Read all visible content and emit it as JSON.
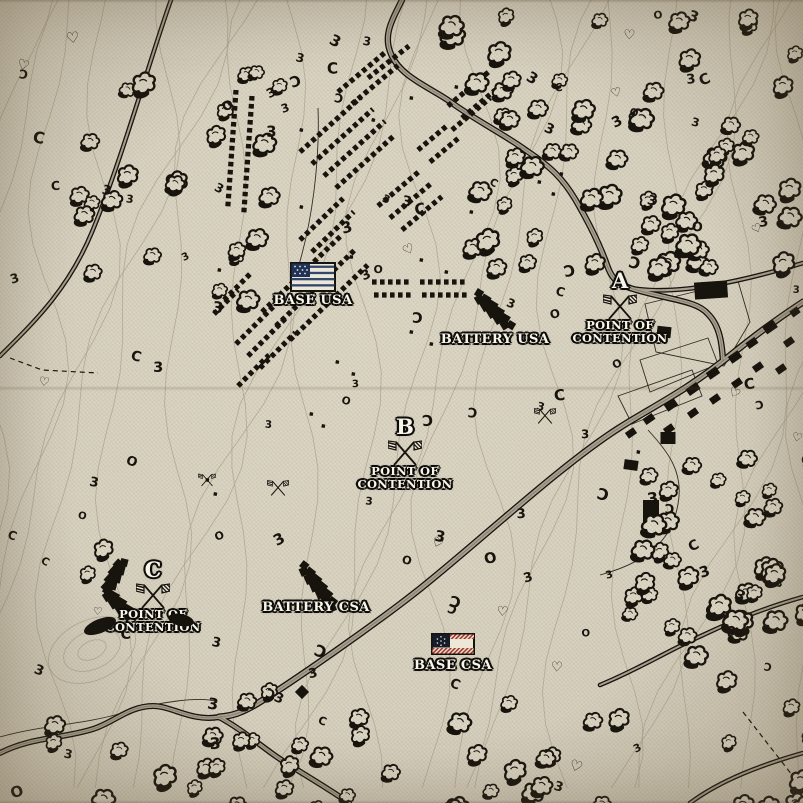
{
  "colors": {
    "parchment": "#d8d2c1",
    "ink": "#16130d",
    "contour": "#b3aa95",
    "road_fill": "#aba393",
    "road_center": "#6e695c",
    "label_text": "#f8f5ea",
    "usa_canton": "#1f3156",
    "usa_stripe": "#31476e",
    "csa_canton": "#171c2a",
    "csa_red": "#9e2a1f",
    "flag_white": "#ece7d7"
  },
  "markers": {
    "base_usa": {
      "label": "BASE USA",
      "x": 313,
      "y": 262
    },
    "battery_usa": {
      "label": "BATTERY USA",
      "x": 495,
      "y": 331
    },
    "battery_csa": {
      "label": "BATTERY CSA",
      "x": 316,
      "y": 599
    },
    "base_csa": {
      "label": "BASE CSA",
      "x": 453,
      "y": 633
    },
    "points_of_contention": [
      {
        "letter": "A",
        "line1": "POINT OF",
        "line2": "CONTENTION",
        "x": 620,
        "y": 270
      },
      {
        "letter": "B",
        "line1": "POINT OF",
        "line2": "CONTENTION",
        "x": 405,
        "y": 416
      },
      {
        "letter": "C",
        "line1": "POINT OF",
        "line2": "CONTENTION",
        "x": 153,
        "y": 559
      }
    ]
  },
  "features": {
    "roads": [
      {
        "d": "M171,0 C152,52 122,160 92,232 C68,290 34,322 0,356",
        "w": 4.6
      },
      {
        "d": "M402,0 C391,22 383,36 391,54 C401,78 432,88 452,103 C477,121 505,135 527,151 C551,167 563,179 575,199 C589,223 600,245 607,265 C611,277 616,283 630,288",
        "w": 6.4
      },
      {
        "d": "M630,288 C668,300 696,300 708,314 C720,326 722,344 723,361",
        "w": 6.4
      },
      {
        "d": "M630,288 C676,296 740,282 803,263",
        "w": 4.8
      },
      {
        "d": "M803,302 C762,329 741,347 723,361 C682,393 652,407 619,428 C561,465 481,540 421,588 C381,620 301,676 263,700 C241,714 231,716 219,717",
        "w": 7
      },
      {
        "d": "M219,717 C192,722 172,706 153,706 C129,706 113,723 93,729 C61,739 31,737 0,753",
        "w": 6
      },
      {
        "d": "M219,717 C241,729 257,743 277,757 C301,773 323,785 349,803",
        "w": 6
      },
      {
        "d": "M600,685 C641,668 669,650 701,636 C741,617 771,606 803,597",
        "w": 4.6
      },
      {
        "d": "M690,803 C721,780 761,765 803,753",
        "w": 4.6
      }
    ],
    "boundaries": [
      "M645,304 L738,281 L750,322 L724,366 L656,352 Z",
      "M640,360 L708,338 L718,364 L650,392 Z",
      "M618,396 L692,370 L702,396 L632,424 Z",
      "M318,108 C320,162 312,222 298,268",
      "M648,430 C668,452 684,472 678,504 C672,540 648,562 600,575",
      "M0,737 C42,725 82,725 122,713 C162,701 198,697 215,701"
    ],
    "fences": [
      "M743,712 L803,789",
      "M10,358 L42,370 L98,373"
    ],
    "tent_rows": [
      [
        236,
        90,
        94,
        118
      ],
      [
        252,
        96,
        94,
        120
      ],
      [
        300,
        152,
        -42,
        82
      ],
      [
        312,
        164,
        -42,
        82
      ],
      [
        324,
        176,
        -42,
        82
      ],
      [
        336,
        188,
        -42,
        80
      ],
      [
        262,
        312,
        -44,
        112
      ],
      [
        276,
        326,
        -44,
        112
      ],
      [
        290,
        340,
        -44,
        108
      ],
      [
        300,
        240,
        -44,
        60
      ],
      [
        312,
        252,
        -44,
        58
      ],
      [
        338,
        92,
        -40,
        62
      ],
      [
        352,
        104,
        -40,
        60
      ],
      [
        368,
        78,
        -38,
        52
      ],
      [
        448,
        106,
        -40,
        56
      ],
      [
        462,
        118,
        -40,
        54
      ],
      [
        452,
        130,
        -40,
        50
      ],
      [
        378,
        206,
        -40,
        56
      ],
      [
        390,
        218,
        -40,
        56
      ],
      [
        402,
        230,
        -40,
        52
      ],
      [
        418,
        150,
        -40,
        40
      ],
      [
        430,
        162,
        -40,
        40
      ],
      [
        372,
        282,
        0,
        40
      ],
      [
        420,
        282,
        0,
        46
      ],
      [
        374,
        295,
        0,
        40
      ],
      [
        422,
        295,
        0,
        46
      ],
      [
        236,
        344,
        -45,
        56
      ],
      [
        248,
        356,
        -45,
        54
      ],
      [
        260,
        368,
        -45,
        50
      ],
      [
        238,
        386,
        -45,
        44
      ],
      [
        224,
        300,
        -45,
        40
      ],
      [
        214,
        314,
        -45,
        34
      ]
    ],
    "buildings": [
      [
        711,
        290,
        33,
        17,
        -4
      ],
      [
        664,
        332,
        14,
        11,
        6
      ],
      [
        770,
        327,
        13,
        9,
        -35
      ],
      [
        789,
        342,
        10,
        7,
        -35
      ],
      [
        752,
        343,
        11,
        7,
        -35
      ],
      [
        735,
        357,
        12,
        8,
        -35
      ],
      [
        758,
        367,
        10,
        7,
        -35
      ],
      [
        713,
        373,
        12,
        8,
        -35
      ],
      [
        737,
        383,
        10,
        7,
        -35
      ],
      [
        693,
        389,
        13,
        8,
        -35
      ],
      [
        715,
        399,
        10,
        7,
        -35
      ],
      [
        671,
        405,
        12,
        8,
        -35
      ],
      [
        693,
        413,
        10,
        7,
        -35
      ],
      [
        649,
        419,
        11,
        7,
        -35
      ],
      [
        669,
        429,
        10,
        7,
        -35
      ],
      [
        631,
        433,
        10,
        7,
        -35
      ],
      [
        795,
        312,
        9,
        7,
        -35
      ],
      [
        781,
        369,
        10,
        7,
        -35
      ],
      [
        668,
        438,
        15,
        12,
        0
      ],
      [
        631,
        465,
        14,
        10,
        8
      ],
      [
        651,
        512,
        16,
        24,
        0
      ],
      [
        302,
        692,
        10,
        10,
        45
      ]
    ],
    "batteries": [
      [
        [
          478,
          295
        ],
        [
          510,
          327
        ]
      ],
      [
        [
          303,
          567
        ],
        [
          334,
          607
        ]
      ],
      [
        [
          122,
          562
        ],
        [
          106,
          592
        ],
        [
          133,
          618
        ]
      ]
    ],
    "ink_blobs": [
      [
        100,
        626,
        17,
        7,
        -22
      ],
      [
        181,
        620,
        13,
        6,
        12
      ]
    ],
    "tree_clusters": [
      [
        432,
        6,
        370,
        252,
        64
      ],
      [
        42,
        55,
        232,
        268,
        24
      ],
      [
        620,
        428,
        183,
        248,
        38
      ],
      [
        272,
        690,
        336,
        112,
        22
      ],
      [
        18,
        672,
        268,
        128,
        15
      ],
      [
        706,
        688,
        95,
        112,
        9
      ],
      [
        70,
        528,
        44,
        44,
        2
      ]
    ],
    "bushes": {
      "count": 115,
      "glyphs": [
        "3",
        "3",
        "3",
        "C",
        "O",
        "♡",
        "Ɔ"
      ]
    },
    "dots": [
      [
        300,
        128
      ],
      [
        268,
        140
      ],
      [
        372,
        118
      ],
      [
        410,
        96
      ],
      [
        455,
        85
      ],
      [
        350,
        255
      ],
      [
        420,
        258
      ],
      [
        445,
        270
      ],
      [
        300,
        205
      ],
      [
        230,
        255
      ],
      [
        218,
        268
      ],
      [
        336,
        360
      ],
      [
        352,
        372
      ],
      [
        310,
        412
      ],
      [
        322,
        424
      ],
      [
        206,
        478
      ],
      [
        214,
        492
      ],
      [
        637,
        450
      ],
      [
        410,
        330
      ],
      [
        430,
        342
      ],
      [
        538,
        180
      ],
      [
        552,
        192
      ],
      [
        560,
        172
      ],
      [
        470,
        210
      ]
    ],
    "mini_flags": [
      [
        278,
        488,
        0.62
      ],
      [
        545,
        416,
        0.62
      ],
      [
        207,
        480,
        0.5
      ]
    ],
    "contours": {
      "lines": 27,
      "hill": [
        92,
        650,
        -25
      ]
    }
  }
}
